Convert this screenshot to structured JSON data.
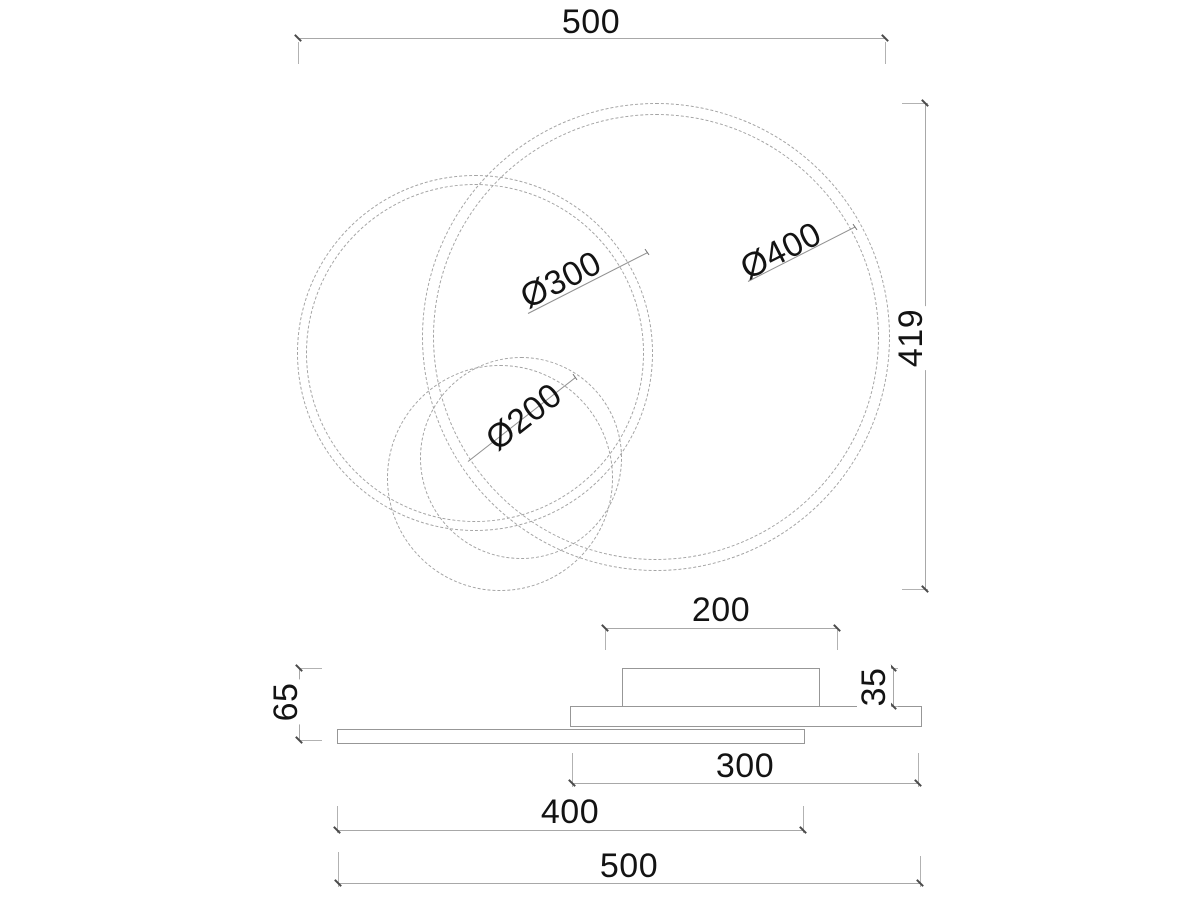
{
  "drawing": {
    "top_view": {
      "width_label": "500",
      "height_label": "419",
      "ring_labels": {
        "large": "Ø400",
        "medium": "Ø300",
        "small": "Ø200"
      }
    },
    "side_view": {
      "canopy_width": "200",
      "canopy_height": "35",
      "fixture_height": "65",
      "plate_width": "300",
      "bar_width": "400",
      "overall_width": "500"
    },
    "colors": {
      "background": "#ffffff",
      "outline": "#979797",
      "circle_line": "#a2a2a2",
      "dimension_line": "#a8a8a8",
      "end_mark": "#4a4a4a",
      "text": "#131313"
    }
  }
}
